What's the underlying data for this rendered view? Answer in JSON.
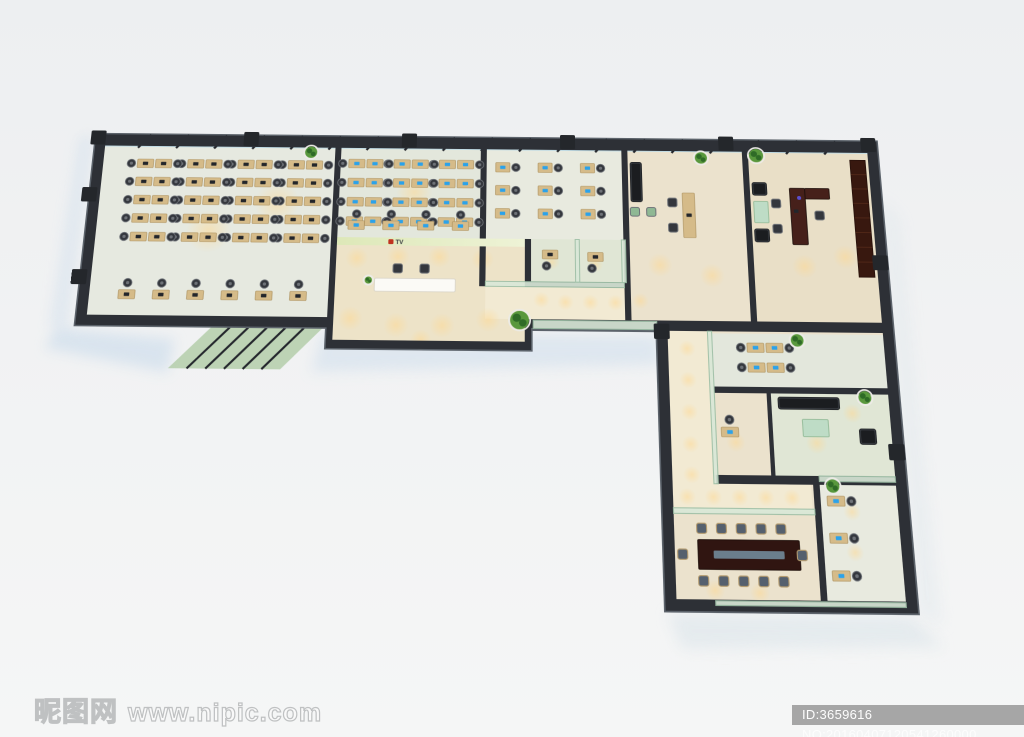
{
  "watermarks": {
    "site_logo_text": "昵图网",
    "site_url": "www.nipic.com",
    "image_id_text": "ID:3659616 NO:20160407120541260000"
  },
  "reception_logo": {
    "text": "TV",
    "emblem_color": "#c0331f"
  },
  "floorplan": {
    "palette": {
      "wall": "#2d3036",
      "wallEdge": "#5c636b",
      "mullion": "#23262c",
      "glassN": "#c0dbe4",
      "glassN2": "#daedf3",
      "glassWall": "#9dbfa6",
      "glassFill": "#d9e8d8",
      "floorA": "#e6e9e0",
      "floorB": "#e3e7dc",
      "floorC": "#e8eadf",
      "corridor": "#f2ead3",
      "reception": "#ede3c8",
      "roomBeige": "#ebe2cd",
      "execFloor": "#e9dfc7",
      "glassRoom": "#e0e6d5",
      "desk": "#d5bb89",
      "deskEdge": "#ab8f5c",
      "chair": "#34373d",
      "chairLite": "#6e7278",
      "chairTan": "#b29a6f",
      "screenBlue": "#2ba2ea",
      "monDark": "#23262b",
      "sofa": "#1b1d20",
      "sofaLine": "#3c4046",
      "greenGlass": "#bedcc6",
      "greenSeat": "#8fb894",
      "mahog": "#46201a",
      "mahogDark": "#301511",
      "bookcase": "#38180f",
      "tableStrip": "#6b7e8c",
      "white": "#fbfaf6",
      "logoWall": "#dde8b8",
      "logoWall2": "#eef3d6",
      "logoRed": "#c0331f",
      "logoText": "#3a3c40",
      "glow": "#ffd890",
      "plant": "#2f6b27",
      "plantLite": "#59983d",
      "pot": "#ecebe6",
      "canopy": "#b7cfae",
      "shadow1": "#cfdeec",
      "shadow2": "#e1e8ec"
    },
    "shell": [
      [
        0,
        0
      ],
      [
        780,
        0
      ],
      [
        780,
        450
      ],
      [
        555,
        450
      ],
      [
        555,
        195
      ],
      [
        435,
        195
      ],
      [
        435,
        215
      ],
      [
        240,
        215
      ],
      [
        240,
        195
      ],
      [
        0,
        195
      ]
    ],
    "shadows": [
      {
        "pts": [
          [
            -18,
            198
          ],
          [
            96,
            208
          ],
          [
            92,
            240
          ],
          [
            -26,
            218
          ]
        ],
        "f": "shadow1",
        "o": 0.7
      },
      {
        "pts": [
          [
            236,
            200
          ],
          [
            556,
            200
          ],
          [
            556,
            228
          ],
          [
            228,
            238
          ]
        ],
        "f": "shadow1",
        "o": 0.55
      },
      {
        "pts": [
          [
            557,
            452
          ],
          [
            772,
            452
          ],
          [
            800,
            478
          ],
          [
            568,
            482
          ]
        ],
        "f": "shadow2",
        "o": 0.8
      },
      {
        "pts": [
          [
            -16,
            2
          ],
          [
            -4,
            2
          ],
          [
            -8,
            204
          ],
          [
            -24,
            194
          ]
        ],
        "f": "shadow1",
        "o": 0.5
      },
      {
        "pts": [
          [
            780,
            60
          ],
          [
            796,
            80
          ],
          [
            800,
            460
          ],
          [
            780,
            450
          ]
        ],
        "f": "shadow2",
        "o": 0.5
      }
    ],
    "canopy": {
      "pts": [
        [
          130,
          196
        ],
        [
          236,
          196
        ],
        [
          198,
          236
        ],
        [
          92,
          236
        ]
      ],
      "lines": 5
    },
    "rooms": [
      {
        "x": 10,
        "y": 12,
        "w": 230,
        "h": 173,
        "f": "floorA"
      },
      {
        "x": 246,
        "y": 12,
        "w": 139,
        "h": 93,
        "f": "floorB"
      },
      {
        "x": 391,
        "y": 12,
        "w": 134,
        "h": 136,
        "f": "floorC"
      },
      {
        "x": 246,
        "y": 105,
        "w": 183,
        "h": 102,
        "f": "reception"
      },
      {
        "x": 435,
        "y": 105,
        "w": 88,
        "h": 43,
        "f": "glassRoom"
      },
      {
        "x": 391,
        "y": 153,
        "w": 134,
        "h": 32,
        "f": "corridor"
      },
      {
        "x": 531,
        "y": 12,
        "w": 114,
        "h": 173,
        "f": "roomBeige"
      },
      {
        "x": 651,
        "y": 12,
        "w": 119,
        "h": 173,
        "f": "execFloor"
      },
      {
        "x": 565,
        "y": 195,
        "w": 205,
        "h": 245,
        "f": "roomBeige"
      },
      {
        "x": 565,
        "y": 195,
        "w": 38,
        "h": 143,
        "f": "corridor"
      },
      {
        "x": 607,
        "y": 197,
        "w": 163,
        "h": 51,
        "f": "floorB"
      },
      {
        "x": 607,
        "y": 252,
        "w": 49,
        "h": 84,
        "f": "roomBeige"
      },
      {
        "x": 660,
        "y": 252,
        "w": 110,
        "h": 78,
        "f": "glassRoom"
      },
      {
        "x": 565,
        "y": 338,
        "w": 127,
        "h": 24,
        "f": "corridor"
      },
      {
        "x": 565,
        "y": 364,
        "w": 127,
        "h": 84,
        "f": "roomBeige"
      },
      {
        "x": 700,
        "y": 334,
        "w": 70,
        "h": 114,
        "f": "floorC"
      }
    ],
    "glows": [
      [
        266,
        126,
        11
      ],
      [
        306,
        124,
        11
      ],
      [
        346,
        124,
        11
      ],
      [
        388,
        126,
        11
      ],
      [
        262,
        186,
        12
      ],
      [
        306,
        192,
        12
      ],
      [
        350,
        192,
        12
      ],
      [
        394,
        186,
        12
      ],
      [
        330,
        206,
        10
      ],
      [
        445,
        166,
        8
      ],
      [
        468,
        168,
        8
      ],
      [
        492,
        168,
        8
      ],
      [
        516,
        168,
        8
      ],
      [
        540,
        166,
        8
      ],
      [
        583,
        212,
        8
      ],
      [
        583,
        242,
        8
      ],
      [
        583,
        272,
        8
      ],
      [
        583,
        302,
        8
      ],
      [
        583,
        330,
        8
      ],
      [
        578,
        350,
        8
      ],
      [
        602,
        350,
        8
      ],
      [
        626,
        350,
        8
      ],
      [
        650,
        350,
        8
      ],
      [
        674,
        350,
        8
      ],
      [
        560,
        130,
        12
      ],
      [
        610,
        140,
        12
      ],
      [
        700,
        130,
        12
      ],
      [
        740,
        120,
        12
      ],
      [
        455,
        128,
        8
      ],
      [
        497,
        130,
        8
      ],
      [
        625,
        300,
        9
      ],
      [
        700,
        300,
        10
      ],
      [
        735,
        272,
        9
      ],
      [
        728,
        362,
        8
      ],
      [
        728,
        398,
        8
      ],
      [
        600,
        432,
        9
      ],
      [
        640,
        434,
        9
      ],
      [
        120,
        100,
        22
      ],
      [
        185,
        70,
        22
      ],
      [
        320,
        58,
        18
      ]
    ],
    "wallsDark": [
      [
        0,
        0,
        780,
        12
      ],
      [
        0,
        0,
        10,
        195
      ],
      [
        770,
        0,
        10,
        450
      ],
      [
        0,
        185,
        246,
        10
      ],
      [
        240,
        185,
        6,
        30
      ],
      [
        429,
        185,
        6,
        30
      ],
      [
        240,
        207,
        195,
        8
      ],
      [
        555,
        185,
        12,
        10
      ],
      [
        605,
        185,
        175,
        10
      ],
      [
        555,
        195,
        10,
        245
      ],
      [
        555,
        440,
        215,
        10
      ],
      [
        240,
        0,
        6,
        207
      ],
      [
        385,
        0,
        6,
        153
      ],
      [
        429,
        105,
        6,
        48
      ],
      [
        525,
        0,
        6,
        185
      ],
      [
        645,
        0,
        6,
        185
      ],
      [
        607,
        248,
        163,
        6
      ],
      [
        656,
        252,
        4,
        86
      ],
      [
        605,
        330,
        165,
        8
      ],
      [
        694,
        334,
        6,
        114
      ]
    ],
    "wallsGlass": [
      [
        391,
        148,
        134,
        5
      ],
      [
        478,
        105,
        4,
        43
      ],
      [
        523,
        105,
        4,
        43
      ],
      [
        437,
        186,
        118,
        8
      ],
      [
        603,
        195,
        4,
        143
      ],
      [
        565,
        360,
        129,
        5
      ],
      [
        700,
        330,
        70,
        5
      ],
      [
        600,
        441,
        170,
        4
      ]
    ],
    "curtain": {
      "x": 10,
      "y": 1,
      "w": 760,
      "h": 12,
      "step": 38
    },
    "pilasters": [
      [
        -5,
        -4
      ],
      [
        148,
        -4
      ],
      [
        306,
        -4
      ],
      [
        464,
        -4
      ],
      [
        622,
        -4
      ],
      [
        764,
        -4
      ],
      [
        -8,
        56
      ],
      [
        -9,
        140
      ],
      [
        766,
        118
      ],
      [
        766,
        300
      ],
      [
        552,
        188
      ]
    ],
    "grids": [
      {
        "x": 44,
        "y": 26,
        "cols": 4,
        "rows": 5,
        "dx": 50,
        "dy": 19,
        "w": 16,
        "h": 9,
        "cx": -6,
        "cy": 4.5,
        "mon": "dark"
      },
      {
        "x": 62,
        "y": 26,
        "cols": 4,
        "rows": 5,
        "dx": 50,
        "dy": 19,
        "w": 16,
        "h": 9,
        "cx": 22,
        "cy": 4.5,
        "mon": "dark"
      },
      {
        "x": 38,
        "y": 160,
        "cols": 6,
        "rows": 1,
        "dx": 33,
        "dy": 0,
        "w": 16,
        "h": 9,
        "cx": 8,
        "cy": -7,
        "mon": "dark"
      },
      {
        "x": 254,
        "y": 24,
        "cols": 3,
        "rows": 4,
        "dx": 45,
        "dy": 20,
        "w": 16,
        "h": 9,
        "cx": -6,
        "cy": 4.5,
        "mon": "blue"
      },
      {
        "x": 272,
        "y": 24,
        "cols": 3,
        "rows": 4,
        "dx": 45,
        "dy": 20,
        "w": 16,
        "h": 9,
        "cx": 22,
        "cy": 4.5,
        "mon": "blue"
      },
      {
        "x": 256,
        "y": 88,
        "cols": 4,
        "rows": 1,
        "dx": 34,
        "dy": 0,
        "w": 16,
        "h": 9,
        "cx": 8,
        "cy": -7,
        "mon": "blue"
      },
      {
        "x": 400,
        "y": 26,
        "cols": 3,
        "rows": 3,
        "dx": 42,
        "dy": 24,
        "w": 14,
        "h": 10,
        "cx": 20,
        "cy": 5,
        "mon": "blue"
      },
      {
        "x": 640,
        "y": 206,
        "cols": 1,
        "rows": 2,
        "dx": 0,
        "dy": 19,
        "w": 16,
        "h": 9,
        "cx": -6,
        "cy": 4.5,
        "mon": "blue"
      },
      {
        "x": 658,
        "y": 206,
        "cols": 1,
        "rows": 2,
        "dx": 0,
        "dy": 19,
        "w": 16,
        "h": 9,
        "cx": 22,
        "cy": 4.5,
        "mon": "blue"
      },
      {
        "x": 706,
        "y": 348,
        "cols": 1,
        "rows": 3,
        "dx": 0,
        "dy": 33,
        "w": 16,
        "h": 9,
        "cx": 22,
        "cy": 4.5,
        "mon": "blue"
      }
    ],
    "desks": [
      {
        "x": 446,
        "y": 116,
        "w": 15,
        "h": 9,
        "cx": 4,
        "cy": 16,
        "mon": "dark"
      },
      {
        "x": 490,
        "y": 118,
        "w": 15,
        "h": 9,
        "cx": 4,
        "cy": 16,
        "mon": "dark"
      },
      {
        "x": 612,
        "y": 286,
        "w": 16,
        "h": 9,
        "cx": 8,
        "cy": -7,
        "mon": "blue"
      },
      {
        "x": 584,
        "y": 56,
        "w": 12,
        "h": 46,
        "mon": "dark"
      }
    ],
    "chairs": [
      {
        "t": "green",
        "x": 537,
        "y": 76
      },
      {
        "t": "green",
        "x": 553,
        "y": 76
      },
      {
        "t": "black",
        "x": 574,
        "y": 66
      },
      {
        "t": "black",
        "x": 574,
        "y": 92
      },
      {
        "t": "black",
        "x": 676,
        "y": 66
      },
      {
        "t": "black",
        "x": 676,
        "y": 92
      },
      {
        "t": "black",
        "x": 718,
        "y": 78
      },
      {
        "t": "black",
        "x": 306,
        "y": 136
      },
      {
        "t": "black",
        "x": 332,
        "y": 136
      },
      {
        "t": "tan",
        "x": 590,
        "y": 378
      },
      {
        "t": "tan",
        "x": 608,
        "y": 378
      },
      {
        "t": "tan",
        "x": 626,
        "y": 378
      },
      {
        "t": "tan",
        "x": 644,
        "y": 378
      },
      {
        "t": "tan",
        "x": 662,
        "y": 378
      },
      {
        "t": "tan",
        "x": 590,
        "y": 424
      },
      {
        "t": "tan",
        "x": 608,
        "y": 424
      },
      {
        "t": "tan",
        "x": 626,
        "y": 424
      },
      {
        "t": "tan",
        "x": 644,
        "y": 424
      },
      {
        "t": "tan",
        "x": 662,
        "y": 424
      },
      {
        "t": "tan",
        "x": 572,
        "y": 401
      },
      {
        "t": "tan",
        "x": 680,
        "y": 401
      }
    ],
    "sofas": [
      [
        533,
        24,
        12,
        42
      ],
      [
        653,
        44,
        15,
        14
      ],
      [
        653,
        92,
        15,
        14
      ],
      [
        666,
        257,
        58,
        12
      ],
      [
        740,
        286,
        16,
        15
      ]
    ],
    "tables": [
      {
        "x": 654,
        "y": 64,
        "w": 14,
        "h": 22,
        "f": "greenGlass"
      },
      {
        "x": 690,
        "y": 50,
        "w": 15,
        "h": 58,
        "f": "mahog"
      },
      {
        "x": 705,
        "y": 50,
        "w": 24,
        "h": 11,
        "f": "mahog"
      },
      {
        "x": 688,
        "y": 278,
        "w": 24,
        "h": 16,
        "f": "greenGlass"
      },
      {
        "x": 586,
        "y": 388,
        "w": 92,
        "h": 26,
        "f": "mahogDark",
        "strip": true
      }
    ],
    "bookcases": [
      [
        752,
        20,
        15,
        120
      ]
    ],
    "execExtras": {
      "monitor": [
        693,
        72
      ],
      "vase": [
        699,
        60
      ]
    },
    "plants": [
      [
        216,
        17,
        6
      ],
      [
        604,
        19,
        6
      ],
      [
        659,
        16,
        7
      ],
      [
        424,
        186,
        9
      ],
      [
        688,
        203,
        6
      ],
      [
        748,
        257,
        6
      ],
      [
        712,
        339,
        6
      ],
      [
        278,
        148,
        3.5
      ]
    ],
    "receptionSet": {
      "logoWallRect": [
        246,
        105,
        183,
        8
      ],
      "deskRect": [
        284,
        146,
        78,
        13
      ],
      "logoPos": [
        296,
        106
      ]
    }
  }
}
